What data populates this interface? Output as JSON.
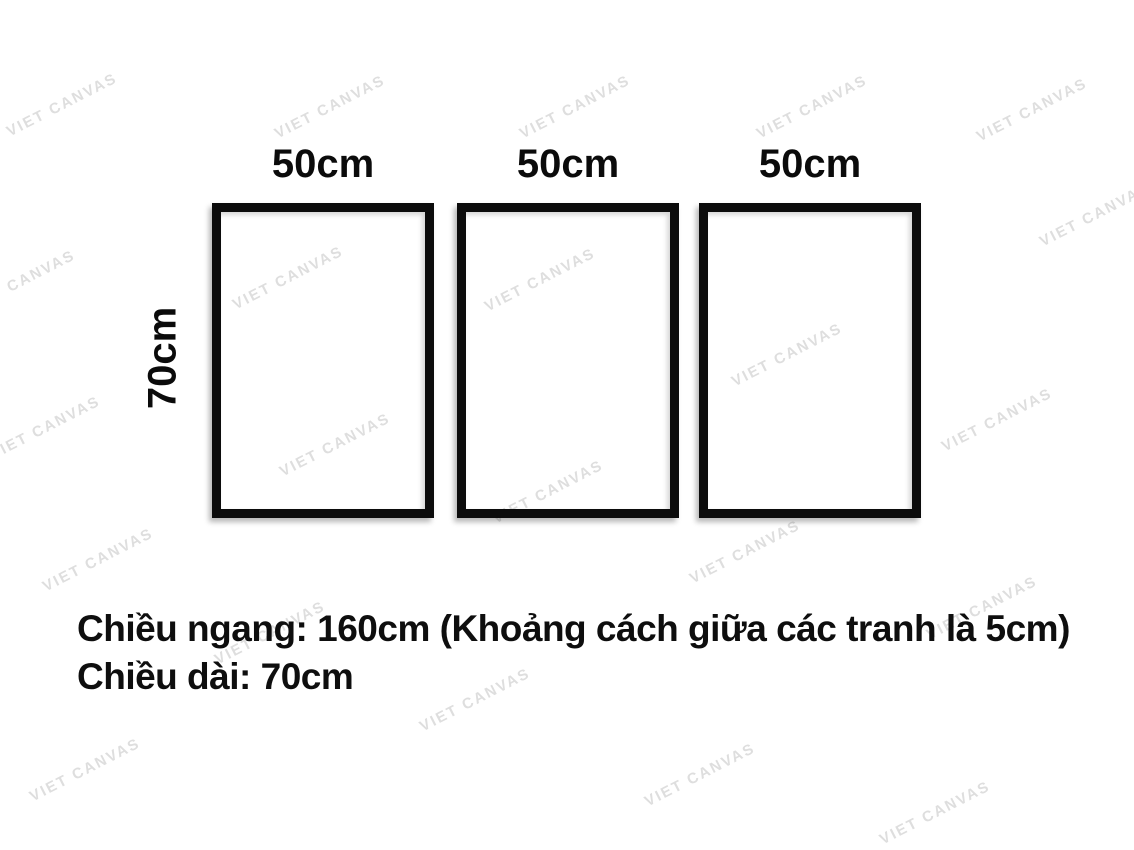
{
  "diagram": {
    "frames": {
      "items": [
        {
          "width_label": "50cm"
        },
        {
          "width_label": "50cm"
        },
        {
          "width_label": "50cm"
        }
      ],
      "height_label": "70cm",
      "frame_color": "#0c0c0c"
    },
    "caption": {
      "line1": "Chiều ngang: 160cm (Khoảng cách giữa các tranh là 5cm)",
      "line2": "Chiều dài: 70cm"
    },
    "text_color": "#0e0e0e"
  },
  "watermark": {
    "text": "VIET CANVAS",
    "color": "#d9d9d9",
    "angle_deg": -27,
    "positions": [
      [
        62,
        105
      ],
      [
        330,
        107
      ],
      [
        575,
        107
      ],
      [
        812,
        107
      ],
      [
        1032,
        110
      ],
      [
        1095,
        215
      ],
      [
        20,
        282
      ],
      [
        288,
        278
      ],
      [
        540,
        280
      ],
      [
        787,
        355
      ],
      [
        997,
        420
      ],
      [
        45,
        428
      ],
      [
        335,
        445
      ],
      [
        548,
        492
      ],
      [
        745,
        552
      ],
      [
        98,
        560
      ],
      [
        982,
        608
      ],
      [
        270,
        633
      ],
      [
        475,
        700
      ],
      [
        85,
        770
      ],
      [
        700,
        775
      ],
      [
        935,
        813
      ]
    ]
  }
}
